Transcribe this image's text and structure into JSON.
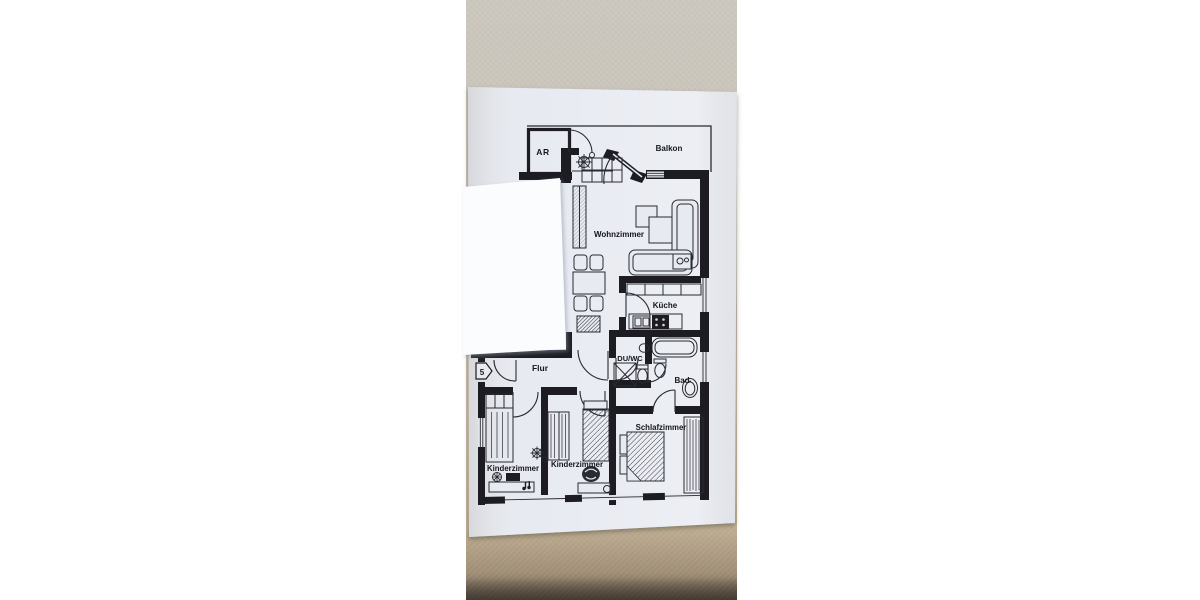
{
  "photo": {
    "wall_color_top": "#cac6bd",
    "wall_color_bottom": "#bfae93",
    "bottom_shadow_color": "#584e42",
    "plan_paper_color": "#e7eaf1",
    "cover_paper_color": "#fbfcfd",
    "ink_color": "#1b1b24"
  },
  "floor_plan": {
    "rooms": [
      {
        "id": "ar",
        "label": "AR"
      },
      {
        "id": "balkon",
        "label": "Balkon"
      },
      {
        "id": "wohnzimmer",
        "label": "Wohnzimmer"
      },
      {
        "id": "kueche",
        "label": "Küche"
      },
      {
        "id": "du-wc",
        "label": "DU/WC"
      },
      {
        "id": "bad",
        "label": "Bad"
      },
      {
        "id": "flur",
        "label": "Flur"
      },
      {
        "id": "schlafzimmer",
        "label": "Schlafzimmer"
      },
      {
        "id": "kinderzimmer-left",
        "label": "Kinderzimmer"
      },
      {
        "id": "kinderzimmer-middle",
        "label": "Kinderzimmer"
      }
    ],
    "entrance_marker": {
      "label": "5"
    }
  }
}
